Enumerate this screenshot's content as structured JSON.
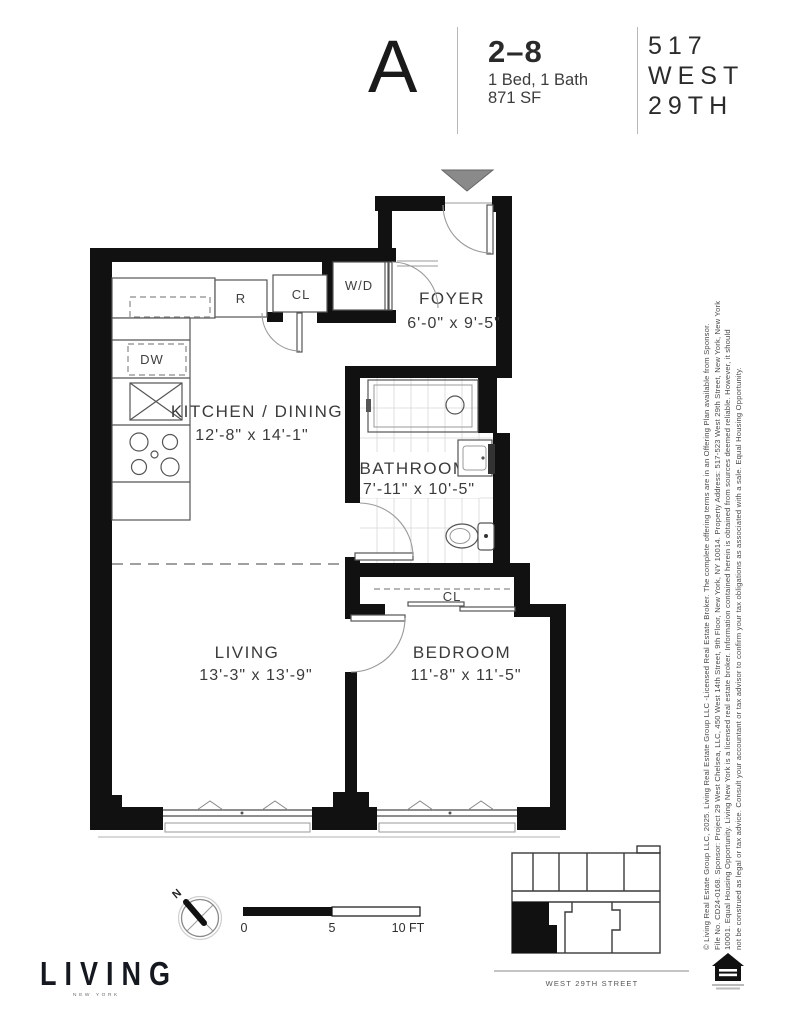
{
  "header": {
    "unit_letter": "A",
    "floors": "2–8",
    "bed_bath": "1 Bed, 1 Bath",
    "area": "871 SF",
    "building_line1": "517",
    "building_line2": "WEST",
    "building_line3": "29TH"
  },
  "plan": {
    "rooms": {
      "foyer": {
        "name": "FOYER",
        "dims": "6'-0\" x 9'-5\""
      },
      "kitchen": {
        "name": "KITCHEN / DINING",
        "dims": "12'-8\" x 14'-1\""
      },
      "bathroom": {
        "name": "BATHROOM",
        "dims": "7'-11\" x 10'-5\""
      },
      "living": {
        "name": "LIVING",
        "dims": "13'-3\" x 13'-9\""
      },
      "bedroom": {
        "name": "BEDROOM",
        "dims": "11'-8\" x 11'-5\""
      }
    },
    "labels": {
      "washer_dryer": "W/D",
      "refrigerator": "R",
      "kitchen_closet": "CL",
      "dishwasher": "DW",
      "bedroom_closet": "CL"
    }
  },
  "compass": {
    "label": "N"
  },
  "scale_bar": {
    "tick0": "0",
    "tick5": "5",
    "tick10": "10 FT"
  },
  "key_plan": {
    "street_label": "WEST 29TH STREET"
  },
  "brand": {
    "logo": "LIVING",
    "logo_sub": "NEW YORK"
  },
  "legal": {
    "line1": "© Living Real Estate Group LLC, 2025. Living Real Estate Group LLC -Licensed Real Estate Broker. The complete offering terms are in an Offering Plan available from Sponsor.",
    "line2": "File No. CD24-0168. Sponsor: Project 29 West Chelsea, LLC, 450 West 14th Street, 9th Floor, New York, NY 10014. Property Address: 517-523 West 29th Street, New York, New York",
    "line3": "10001. Equal Housing Opportunity. Living New York is a licensed real estate broker. Information contained herein is obtained from sources deemed reliable. However, it should",
    "line4": "not be construed as legal or tax advice. Consult your accountant or tax advisor to confirm your tax obligations as associated with a sale. Equal Housing Opportunity."
  },
  "colors": {
    "wall": "#111111",
    "entry_marker": "#8a8a8a",
    "ink": "#3b3b3b"
  }
}
